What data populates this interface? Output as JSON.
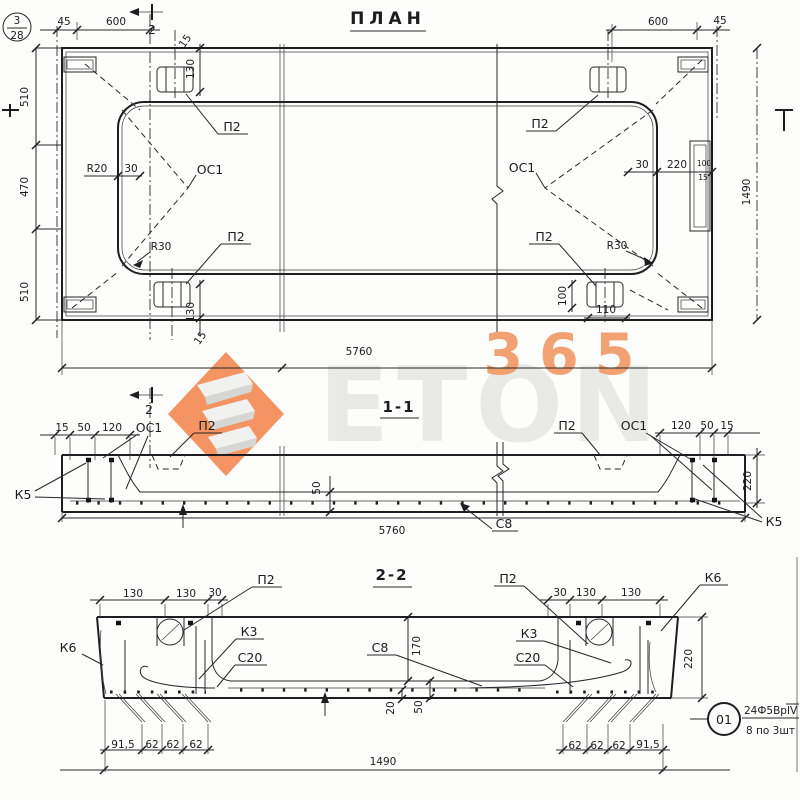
{
  "sheet": {
    "badge_top": "3",
    "badge_bottom": "28"
  },
  "watermark": {
    "word": "ETON",
    "number": "365",
    "accent": "#f4844c"
  },
  "plan": {
    "title": "ПЛАН",
    "cut2_top": "2",
    "dim_45_left": "45",
    "dim_600_left": "600",
    "dim_600_right": "600",
    "dim_45_right": "45",
    "dim_510_top": "510",
    "dim_470": "470",
    "dim_510_bottom": "510",
    "dim_1490": "1490",
    "dim_130_top_loop": "130",
    "dim_15_top_loop": "15",
    "dim_130_bottom_loop": "130",
    "dim_15_bottom_loop": "15",
    "dim_100_loop": "100",
    "dim_110_loop": "110",
    "radius_r20": "R20",
    "dim_30_left": "30",
    "radius_r30_left": "R30",
    "radius_r30_right": "R30",
    "dim_30_right": "30",
    "dim_220_right": "220",
    "dim_100_edge": "100",
    "dim_15_edge": "15",
    "dim_5760": "5760",
    "p2_tl": "П2",
    "p2_bl": "П2",
    "p2_tr": "П2",
    "p2_br": "П2",
    "oc1_left": "ОС1",
    "oc1_right": "ОС1"
  },
  "section11": {
    "title": "1-1",
    "cut2": "2",
    "dim_15_l": "15",
    "dim_50_l": "50",
    "dim_120_l": "120",
    "oc1_l": "ОС1",
    "p2_l": "П2",
    "k5_l": "К5",
    "dim_50_mid": "50",
    "dim_5760": "5760",
    "c8": "С8",
    "p2_r": "П2",
    "oc1_r": "ОС1",
    "dim_120_r": "120",
    "dim_50_r": "50",
    "dim_15_r": "15",
    "dim_220_r": "220",
    "k5_r": "К5"
  },
  "section22": {
    "title": "2-2",
    "dim_130_l1": "130",
    "dim_130_l2": "130",
    "dim_30_l": "30",
    "p2_l": "П2",
    "k3_l": "К3",
    "c20_l": "С20",
    "k6_l": "К6",
    "p2_r": "П2",
    "dim_30_r": "30",
    "dim_130_r1": "130",
    "dim_130_r2": "130",
    "k6_r": "К6",
    "k3_r": "К3",
    "c20_r": "С20",
    "c8": "С8",
    "dim_170": "170",
    "dim_220": "220",
    "dim_20": "20",
    "dim_50": "50",
    "dim_91_5_l": "91,5",
    "dim_62_l1": "62",
    "dim_62_l2": "62",
    "dim_62_l3": "62",
    "dim_62_r1": "62",
    "dim_62_r2": "62",
    "dim_62_r3": "62",
    "dim_91_5_r": "91,5",
    "dim_1490": "1490"
  },
  "callout": {
    "number": "01",
    "spec": "24Ф5ВрIV",
    "count": "8 по 3шт"
  }
}
